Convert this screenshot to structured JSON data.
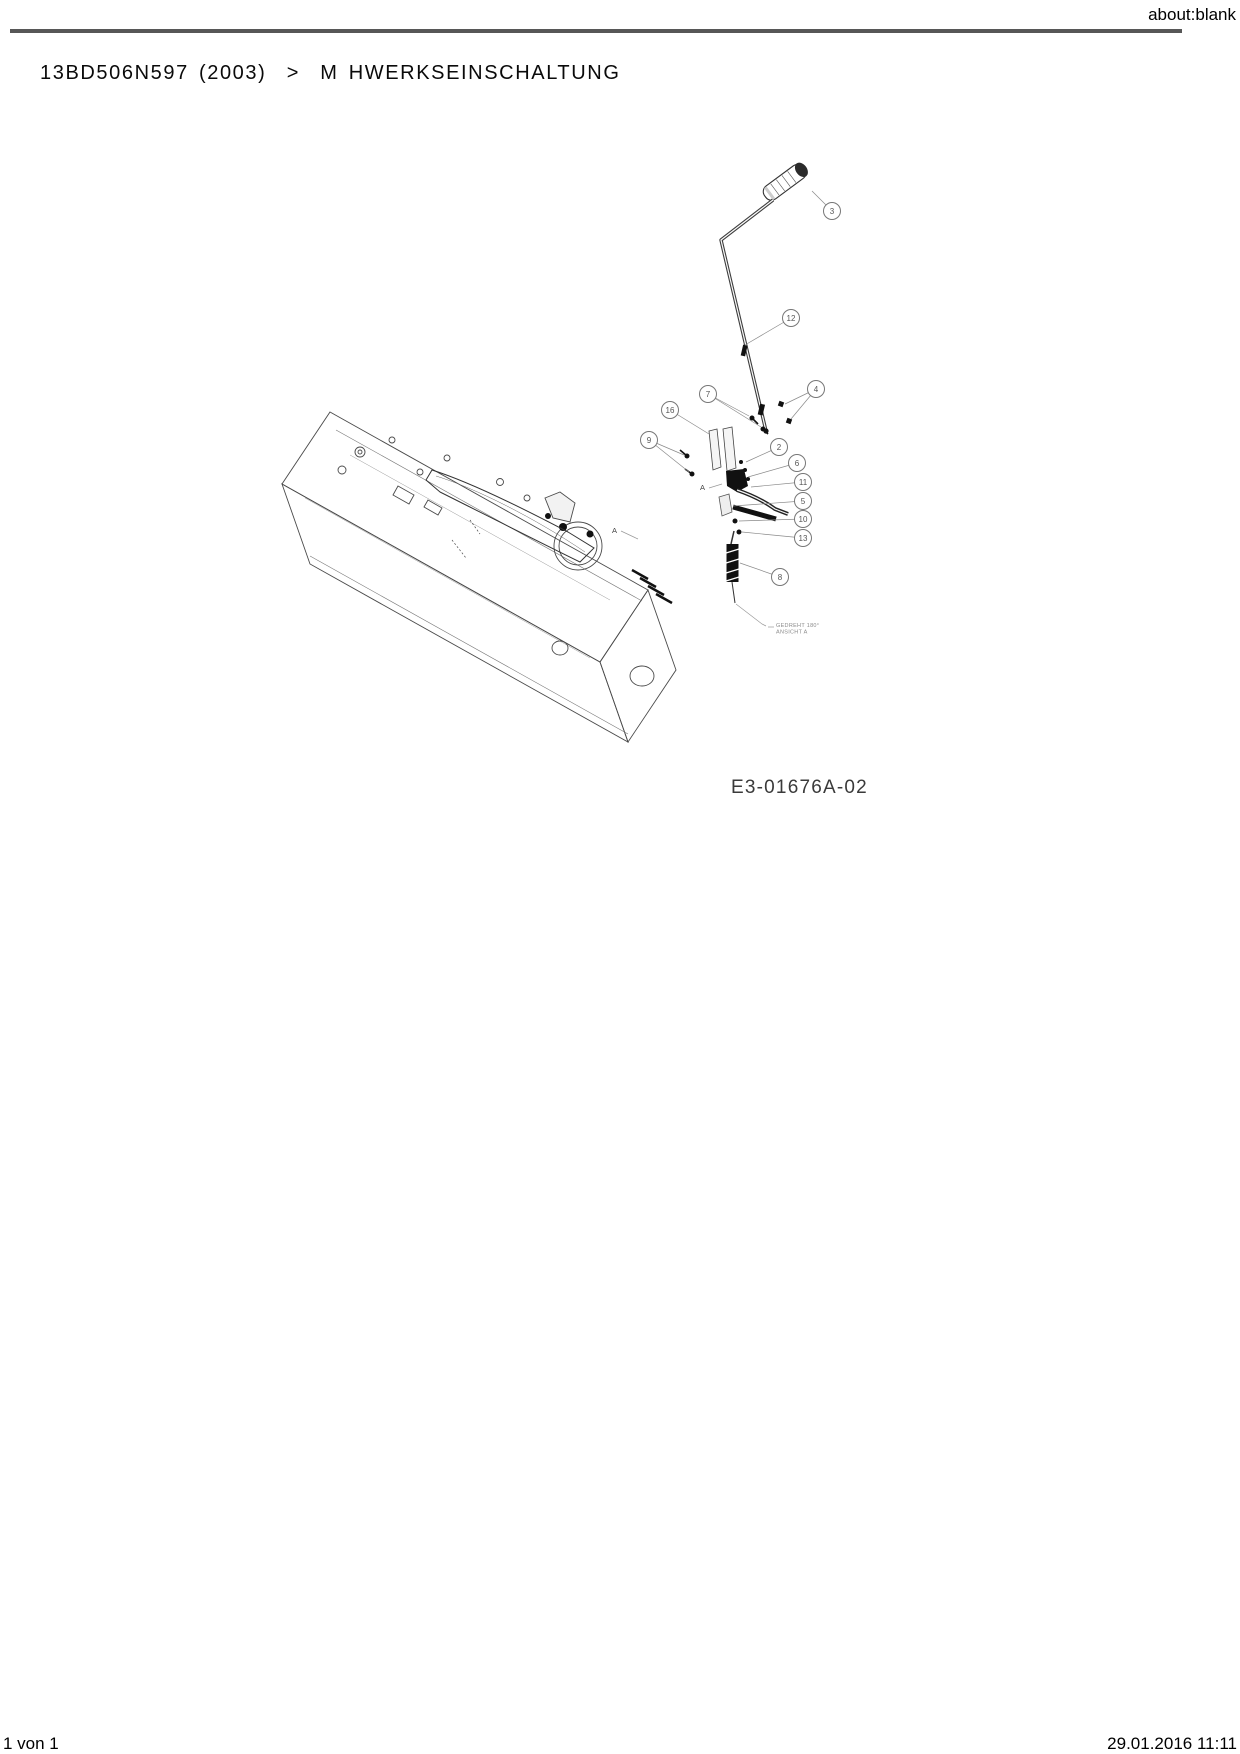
{
  "header": {
    "url": "about:blank"
  },
  "title": {
    "breadcrumb": "13BD506N597 (2003)  >  M HWERKSEINSCHALTUNG"
  },
  "diagram": {
    "drawing_number": "E3-01676A-02",
    "note": {
      "x": 776,
      "y": 622,
      "lines": [
        "GEDREHT 180°",
        "ANSICHT A"
      ]
    },
    "view_labels": [
      {
        "text": "A",
        "x": 700,
        "y": 490
      },
      {
        "text": "A",
        "x": 612,
        "y": 533
      }
    ],
    "callouts": [
      {
        "num": "3",
        "x": 832,
        "y": 211,
        "leaders": [
          [
            812,
            191
          ]
        ]
      },
      {
        "num": "12",
        "x": 791,
        "y": 318,
        "leaders": [
          [
            745,
            345
          ]
        ]
      },
      {
        "num": "7",
        "x": 708,
        "y": 394,
        "leaders": [
          [
            749,
            416
          ],
          [
            761,
            427
          ]
        ]
      },
      {
        "num": "4",
        "x": 816,
        "y": 389,
        "leaders": [
          [
            785,
            404
          ],
          [
            791,
            419
          ]
        ]
      },
      {
        "num": "16",
        "x": 670,
        "y": 410,
        "leaders": [
          [
            709,
            434
          ]
        ]
      },
      {
        "num": "9",
        "x": 649,
        "y": 440,
        "leaders": [
          [
            684,
            455
          ],
          [
            689,
            472
          ]
        ]
      },
      {
        "num": "2",
        "x": 779,
        "y": 447,
        "leaders": [
          [
            746,
            462
          ]
        ]
      },
      {
        "num": "6",
        "x": 797,
        "y": 463,
        "leaders": [
          [
            748,
            477
          ]
        ]
      },
      {
        "num": "11",
        "x": 803,
        "y": 482,
        "leaders": [
          [
            751,
            487
          ]
        ]
      },
      {
        "num": "5",
        "x": 803,
        "y": 501,
        "leaders": [
          [
            733,
            506
          ]
        ]
      },
      {
        "num": "10",
        "x": 803,
        "y": 519,
        "leaders": [
          [
            739,
            521
          ]
        ]
      },
      {
        "num": "13",
        "x": 803,
        "y": 538,
        "leaders": [
          [
            742,
            532
          ]
        ]
      },
      {
        "num": "8",
        "x": 780,
        "y": 577,
        "leaders": [
          [
            740,
            563
          ]
        ]
      }
    ]
  },
  "footer": {
    "page_info": "1 von 1",
    "timestamp": "29.01.2016 11:11"
  }
}
